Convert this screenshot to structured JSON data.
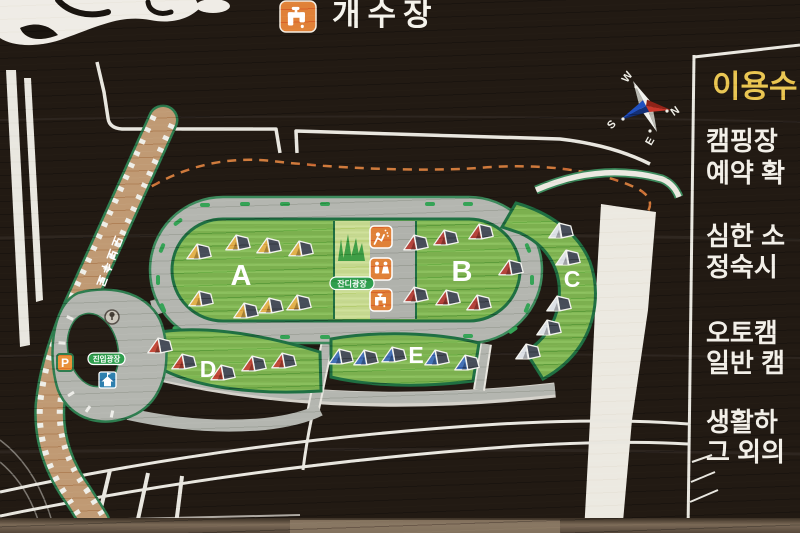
{
  "sign_type": "campground-guide-map",
  "top_facility": {
    "icon": "faucet-icon",
    "label": "개수장"
  },
  "compass": {
    "west": "W",
    "north": "N",
    "south": "S",
    "east": "E",
    "colors": {
      "north_arm": "#c9362a",
      "south_arm": "#2050c0",
      "other_arms": "#f2f2ee"
    }
  },
  "rules_panel": {
    "title": "이용수",
    "title_color": "#e9c653",
    "lines": [
      "캠핑장",
      "예약 확",
      "심한 소",
      "정숙시",
      "오토캠",
      "일반 캠",
      "생활하",
      "그 외의"
    ]
  },
  "map": {
    "zones": [
      {
        "id": "A",
        "label": "A",
        "tent_color": "#e2b14c",
        "tent_count": 8
      },
      {
        "id": "B",
        "label": "B",
        "tent_color": "#b5443c",
        "tent_count": 7
      },
      {
        "id": "C",
        "label": "C",
        "tent_color": "#dde1e6",
        "tent_count": 5
      },
      {
        "id": "D",
        "label": "D",
        "tent_color": "#c24a3a",
        "tent_count": 5
      },
      {
        "id": "E",
        "label": "E",
        "tent_color": "#4471b6",
        "tent_count": 5
      }
    ],
    "labels": {
      "lawn_plaza": "잔디광장",
      "entry_plaza": "진입광장",
      "boardwalk": "도보수로",
      "parking": "P"
    },
    "facility_icons": [
      "shower-icon",
      "restroom-icon",
      "faucet-icon",
      "grass-icon",
      "house-icon",
      "roundabout-icon",
      "parking-icon"
    ],
    "boundary_line_color": "#cf7a3c"
  },
  "colors": {
    "sign_background": "#221a13",
    "road_gray": "#b4b6b0",
    "road_white": "#ece9e1",
    "zone_green": "#7cb04f",
    "zone_border": "#1f6f42",
    "lawn_light": "#c4d78d",
    "badge_green": "#2f9e4e",
    "icon_orange": "#e08138",
    "boardwalk_brown": "#c09a74"
  }
}
